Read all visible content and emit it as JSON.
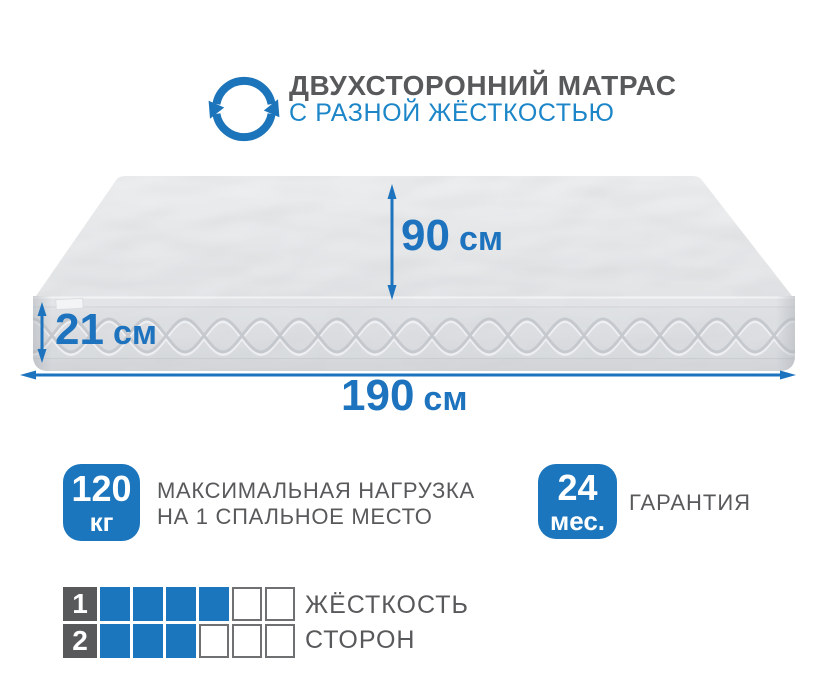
{
  "header": {
    "icon": "rotate-arrows",
    "title": "ДВУХСТОРОННИЙ МАТРАС",
    "subtitle": "С РАЗНОЙ ЖЁСТКОСТЬЮ"
  },
  "dimensions": {
    "height": {
      "value": "90",
      "unit": "см"
    },
    "thickness": {
      "value": "21",
      "unit": "см"
    },
    "width": {
      "value": "190",
      "unit": "см"
    }
  },
  "badges": [
    {
      "value": "120",
      "unit": "кг",
      "caption_line1": "МАКСИМАЛЬНАЯ НАГРУЗКА",
      "caption_line2": "НА 1 СПАЛЬНОЕ МЕСТО"
    },
    {
      "value": "24",
      "unit": "мес.",
      "caption_line1": "ГАРАНТИЯ"
    }
  ],
  "firmness": {
    "caption_line1": "ЖЁСТКОСТЬ",
    "caption_line2": "СТОРОН",
    "rows": [
      {
        "side": "1",
        "filled": 4,
        "total": 6
      },
      {
        "side": "2",
        "filled": 3,
        "total": 6
      }
    ]
  },
  "colors": {
    "accent_blue": "#1e73be",
    "subtitle_blue": "#1c86c8",
    "badge_blue": "#1b76bd",
    "text_gray": "#58595b",
    "cell_border_gray": "#6f7072"
  }
}
